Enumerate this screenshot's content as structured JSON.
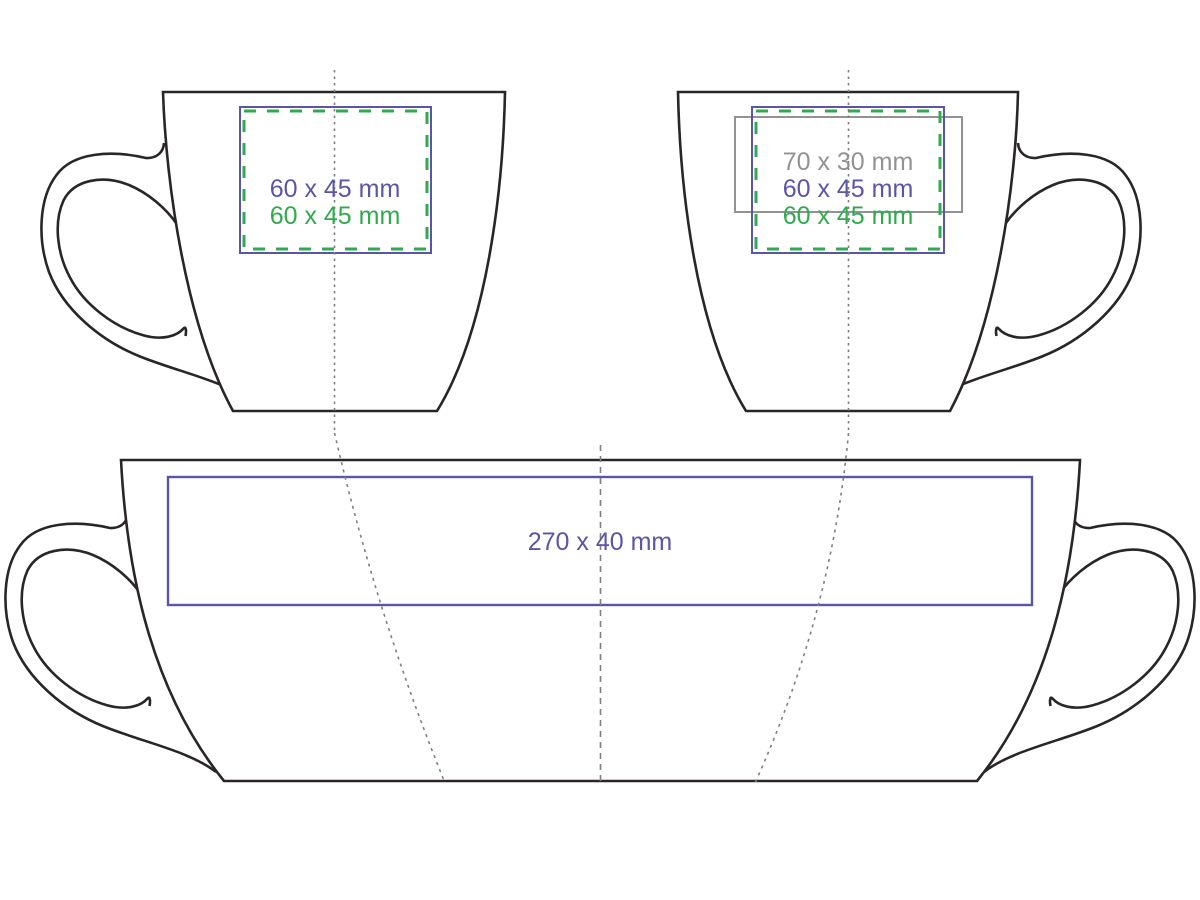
{
  "title": "Mug print area template",
  "colors": {
    "blue": "#5b55a7",
    "green": "#2fab4e",
    "gray": "#929295",
    "outline": "#2a2627",
    "guide": "#7f7f7f",
    "background": "#ffffff"
  },
  "views": {
    "front": {
      "area_blue_label": "60 x 45 mm",
      "area_green_label": "60 x 45 mm"
    },
    "back": {
      "area_gray_label": "70 x 30 mm",
      "area_blue_label": "60 x 45 mm",
      "area_green_label": "60 x 45 mm"
    },
    "wrap": {
      "area_blue_label": "270 x 40 mm"
    }
  }
}
